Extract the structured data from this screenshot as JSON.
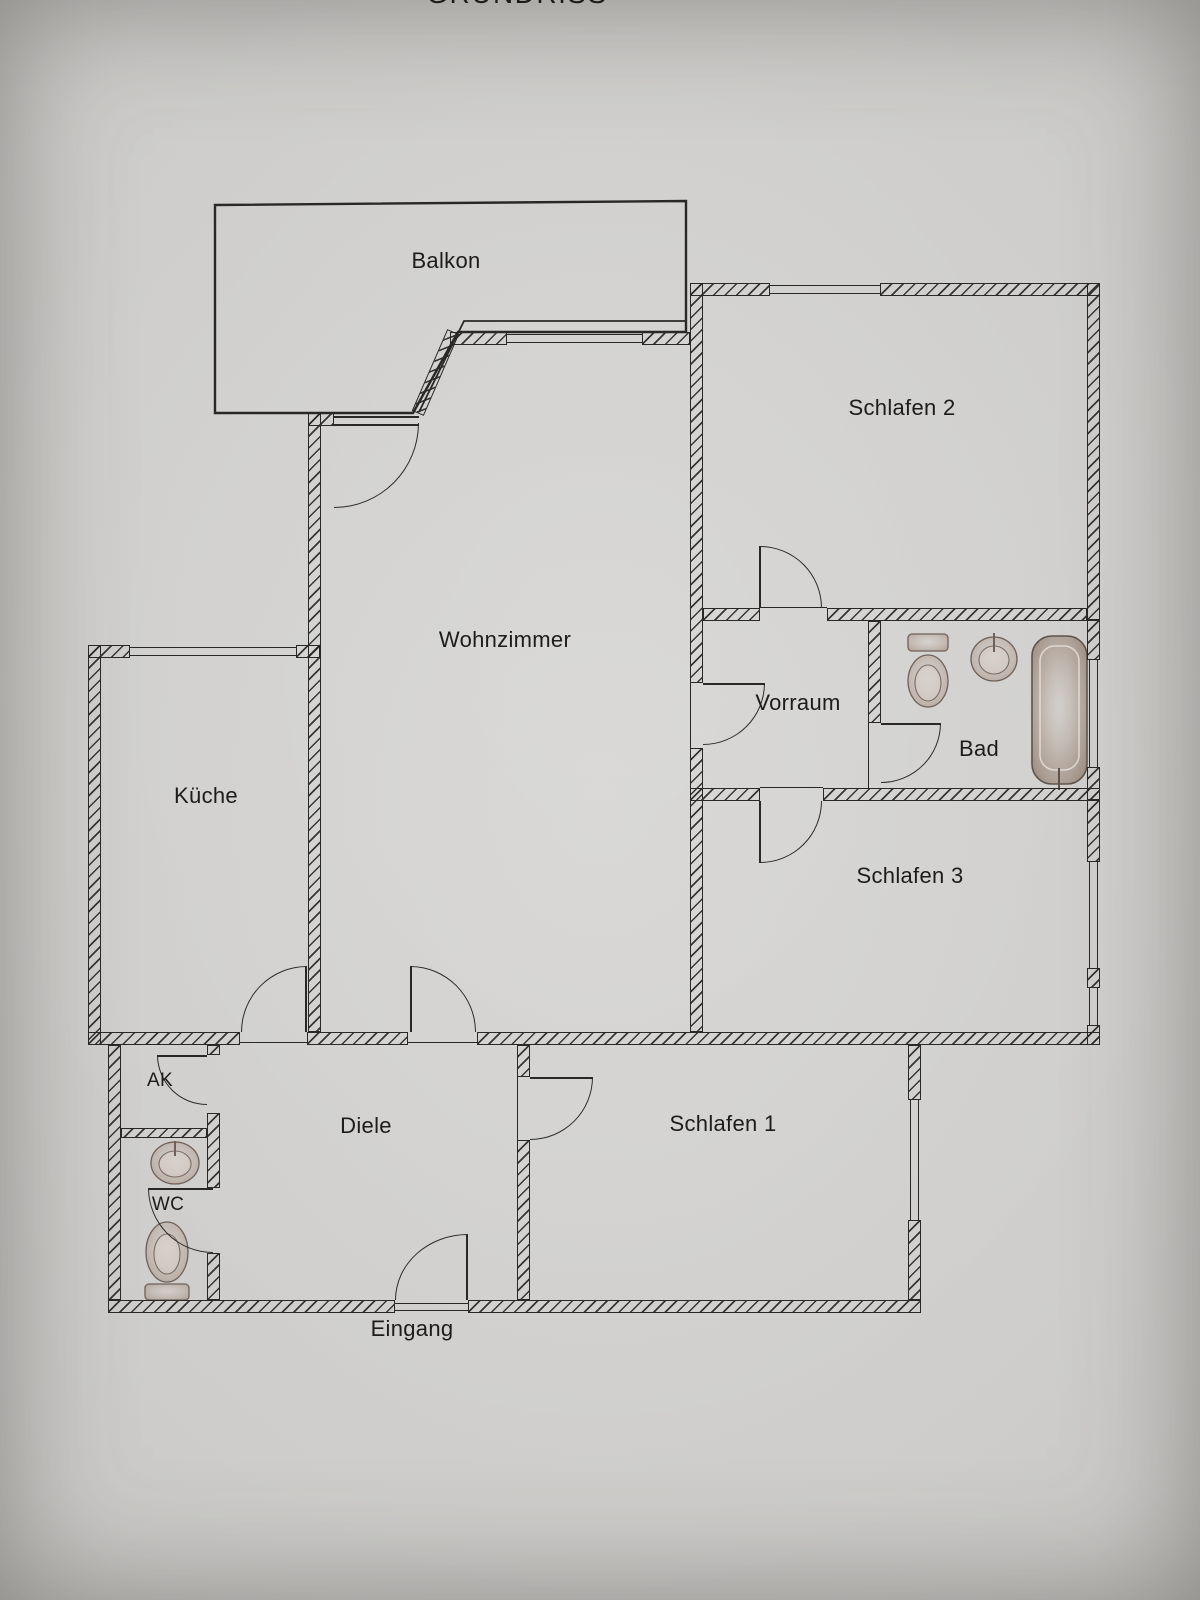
{
  "title": {
    "text": "GRUNDRISS"
  },
  "rooms": {
    "balkon": "Balkon",
    "schlafen2": "Schlafen 2",
    "wohnzimmer": "Wohnzimmer",
    "kueche": "Küche",
    "vorraum": "Vorraum",
    "bad": "Bad",
    "schlafen3": "Schlafen 3",
    "ak": "AK",
    "wc": "WC",
    "diele": "Diele",
    "schlafen1": "Schlafen 1"
  },
  "annotations": {
    "eingang": "Eingang"
  },
  "fixtures": {
    "bad": [
      "toilet",
      "sink",
      "bathtub"
    ],
    "wc": [
      "sink",
      "toilet"
    ]
  },
  "colors": {
    "paper": "#c9c8c6",
    "line": "#2a2826",
    "fixture_tint": "#9a8477"
  }
}
